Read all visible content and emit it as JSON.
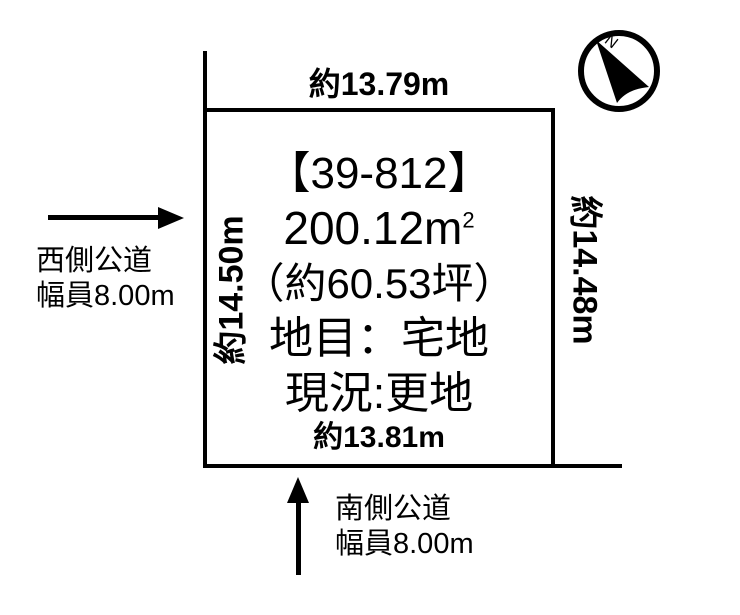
{
  "page": {
    "background_color": "#ffffff",
    "ink_color": "#000000"
  },
  "plot": {
    "id_label": "【39-812】",
    "area_m2": "200.12m",
    "area_m2_sup": "2",
    "area_tsubo": "（約60.53坪）",
    "land_category": "地目：宅地",
    "current_status": "現況:更地",
    "dims": {
      "top": "約13.79m",
      "bottom": "約13.81m",
      "left": "約14.50m",
      "right": "約14.48m"
    }
  },
  "roads": {
    "west": {
      "name": "西側公道",
      "width": "幅員8.00m"
    },
    "south": {
      "name": "南側公道",
      "width": "幅員8.00m"
    }
  },
  "compass": {
    "north_label": "N"
  }
}
